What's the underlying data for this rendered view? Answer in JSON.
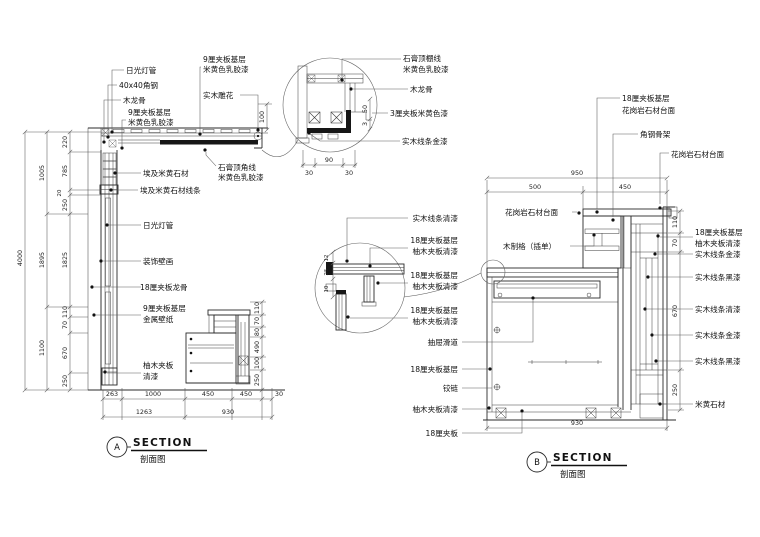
{
  "colors": {
    "line": "#2b2b2b",
    "dim_line": "#5a5a5a",
    "text": "#111111",
    "background": "#ffffff"
  },
  "titles": {
    "a": {
      "bubble": "A",
      "title": "SECTION",
      "subtitle": "剖面图"
    },
    "b": {
      "bubble": "B",
      "title": "SECTION",
      "subtitle": "剖面图"
    }
  },
  "section_a": {
    "labels": {
      "fluorescent_top": "日光灯管",
      "angle_steel": "40x40角钢",
      "wood_keel_top": "木龙骨",
      "plywood9_1a": "9厘夹板基层",
      "plywood9_1b": "米黄色乳胶漆",
      "plywood9_2a": "9厘夹板基层",
      "plywood9_2b": "米黄色乳胶漆",
      "wood_carving": "实木雕花",
      "gypsum_corner_1": "石膏顶角线",
      "gypsum_corner_2": "米黄色乳胶漆",
      "egypt_stone": "埃及米黄石材",
      "egypt_stone_trim": "埃及米黄石材线条",
      "fluorescent_mid": "日光灯管",
      "mural": "装饰壁画",
      "plywood18_keel": "18厘夹板龙骨",
      "plywood9_3a": "9厘夹板基层",
      "plywood9_3b": "金属壁纸",
      "teak_1": "柚木夹板",
      "teak_2": "清漆"
    },
    "dims": {
      "total": "4000",
      "h1": "1005",
      "h2": "1895",
      "h3": "1100",
      "s1": "220",
      "s2": "785",
      "s3": "20",
      "s4": "250",
      "s5": "1825",
      "s6": "110",
      "s7": "70",
      "s8": "670",
      "s9": "250",
      "cove": "100",
      "b1": "263",
      "b2": "1000",
      "b3": "450",
      "b4": "450",
      "b5": "30",
      "b6": "1263",
      "b7": "930",
      "c1": "110",
      "c2": "70",
      "c3": "80",
      "c4": "490",
      "c5": "100",
      "c6": "250"
    }
  },
  "detail_a": {
    "labels": {
      "l1a": "石膏顶棚线",
      "l1b": "米黄色乳胶漆",
      "l2": "木龙骨",
      "l3": "3厘夹板米黄色漆",
      "l4": "实木线条金漆"
    },
    "dims": {
      "w": "90",
      "w1": "30",
      "w2": "30",
      "d1": "50",
      "d2": "3"
    }
  },
  "section_b": {
    "labels_top": {
      "t1a": "18厘夹板基层",
      "t1b": "花岗岩石材台面",
      "t2": "角钢骨架",
      "t3": "花岗岩石材台面",
      "t4": "花岗岩石材台面",
      "t5": "木制格（插单）"
    },
    "labels_left": {
      "l1": "实木线条清漆",
      "l2a": "18厘夹板基层",
      "l2b": "柚木夹板清漆",
      "l3a": "18厘夹板基层",
      "l3b": "柚木夹板清漆",
      "l4a": "18厘夹板基层",
      "l4b": "柚木夹板清漆",
      "l5": "抽屉滑道",
      "l6": "18厘夹板基层",
      "l7": "铰链",
      "l8": "柚木夹板清漆",
      "l9": "18厘夹板"
    },
    "labels_right": {
      "r1": "18厘夹板基层",
      "r2": "柚木夹板清漆",
      "r3": "实木线条金漆",
      "r4": "实木线条黑漆",
      "r5": "实木线条清漆",
      "r6": "实木线条金漆",
      "r7": "实木线条黑漆",
      "r8": "米黄石材"
    },
    "dims": {
      "top": "950",
      "t1": "500",
      "t2": "450",
      "r1": "110",
      "r2": "70",
      "r3": "670",
      "r4": "250",
      "bottom": "930",
      "d1": "12",
      "d2": "25",
      "d3": "10"
    }
  }
}
